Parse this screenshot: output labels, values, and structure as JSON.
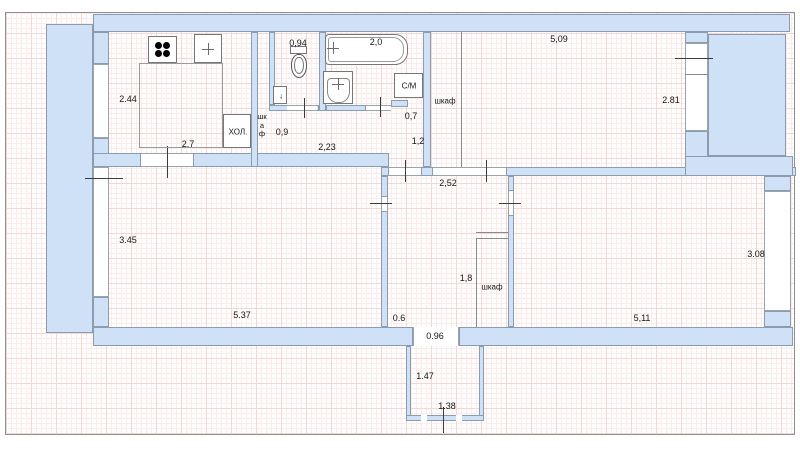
{
  "title": "floor-plan",
  "colors": {
    "wall_fill": "#cfe1f6",
    "wall_stroke": "#8c9cad",
    "grid_minor": "#f9ecea",
    "grid_major": "#f1d8d4",
    "border": "#8f8f8f"
  },
  "labels": {
    "kitchen_width": "2.44",
    "kitchen_length": "2.7",
    "fridge": "ХОЛ.",
    "closet_vertical": "шкаф",
    "closet_width": "0,9",
    "wc_width": "0,94",
    "hallway_length": "2,23",
    "bath_length": "2,0",
    "sm_niche_width": "0,7",
    "washing_machine": "С/М",
    "hallway_width": "1,2",
    "top_right_closet": "шкаф",
    "room1_length": "5,09",
    "room1_width": "2.81",
    "living_width": "3.45",
    "living_length": "5.37",
    "hall_width": "2,52",
    "hall_closet_depth": "1,8",
    "hall_closet": "шкаф",
    "wall_segment": "0.6",
    "room2_length": "5,11",
    "room2_width": "3.08",
    "balcony_door_width": "0.96",
    "balcony_depth": "1.47",
    "balcony_width": "1.38"
  },
  "icons": {
    "down_arrow": "↓"
  }
}
